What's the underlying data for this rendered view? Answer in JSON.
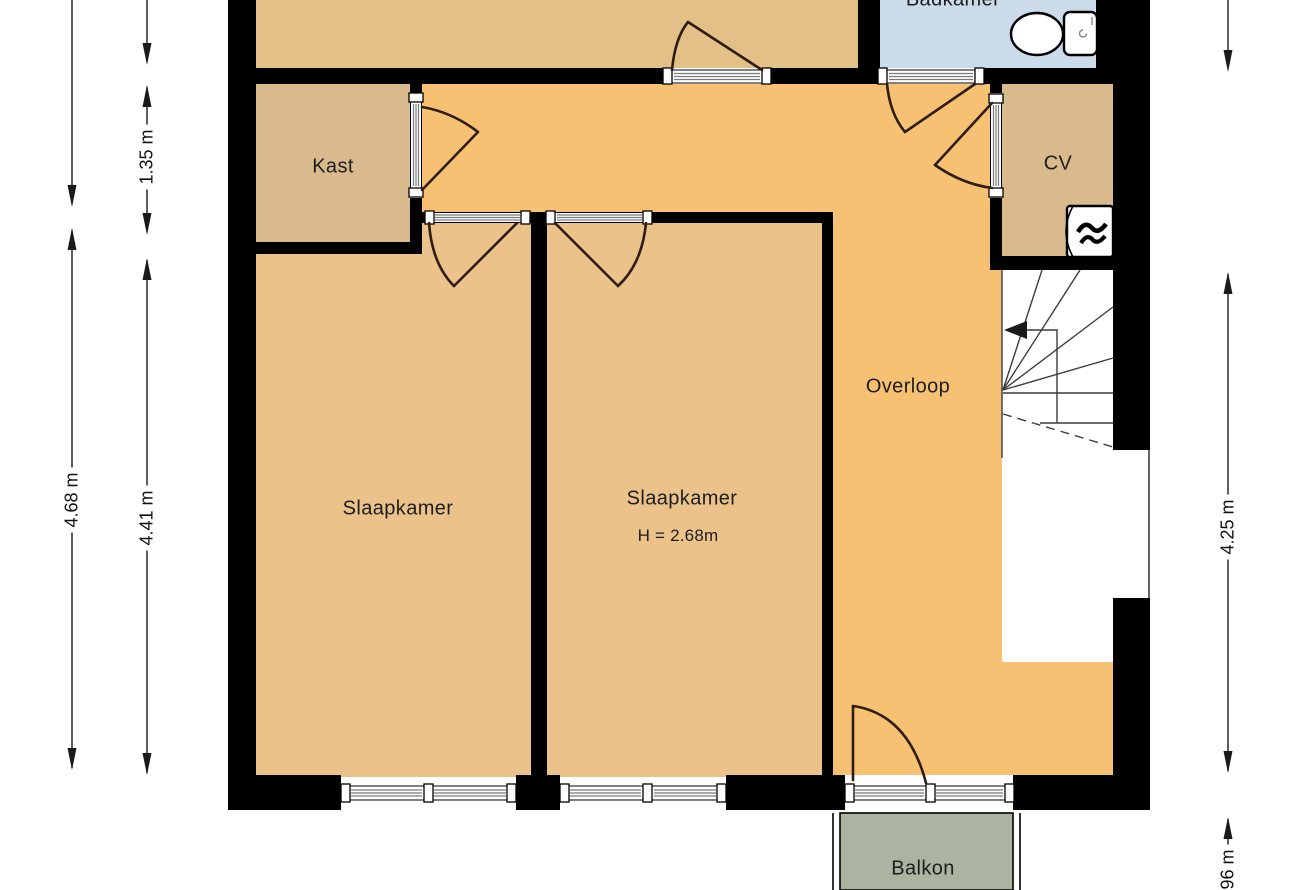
{
  "rooms": {
    "badkamer": "Badkamer",
    "kast": "Kast",
    "cv": "CV",
    "overloop": "Overloop",
    "slaapkamer_left": "Slaapkamer",
    "slaapkamer_right": "Slaapkamer",
    "slaapkamer_right_height": "H = 2.68m",
    "balkon": "Balkon"
  },
  "dimensions": {
    "left_outer": "4.68 m",
    "left_inner_top": "1.35 m",
    "left_inner_bottom": "4.41 m",
    "right_main": "4.25 m",
    "right_balcony": ".96 m"
  },
  "icons": {
    "toilet": "toilet-icon",
    "boiler": "boiler-flame-icon",
    "stairs_arrow": "stairs-direction-arrow-icon"
  },
  "colors": {
    "hall": "#f7c174",
    "bedroom": "#eac28a",
    "service": "#d9ba8c",
    "top_room": "#e3c088",
    "bathroom": "#cbdbea",
    "balcony": "#abb4a1",
    "wall": "#000000",
    "door_arc": "#2e1d10"
  }
}
